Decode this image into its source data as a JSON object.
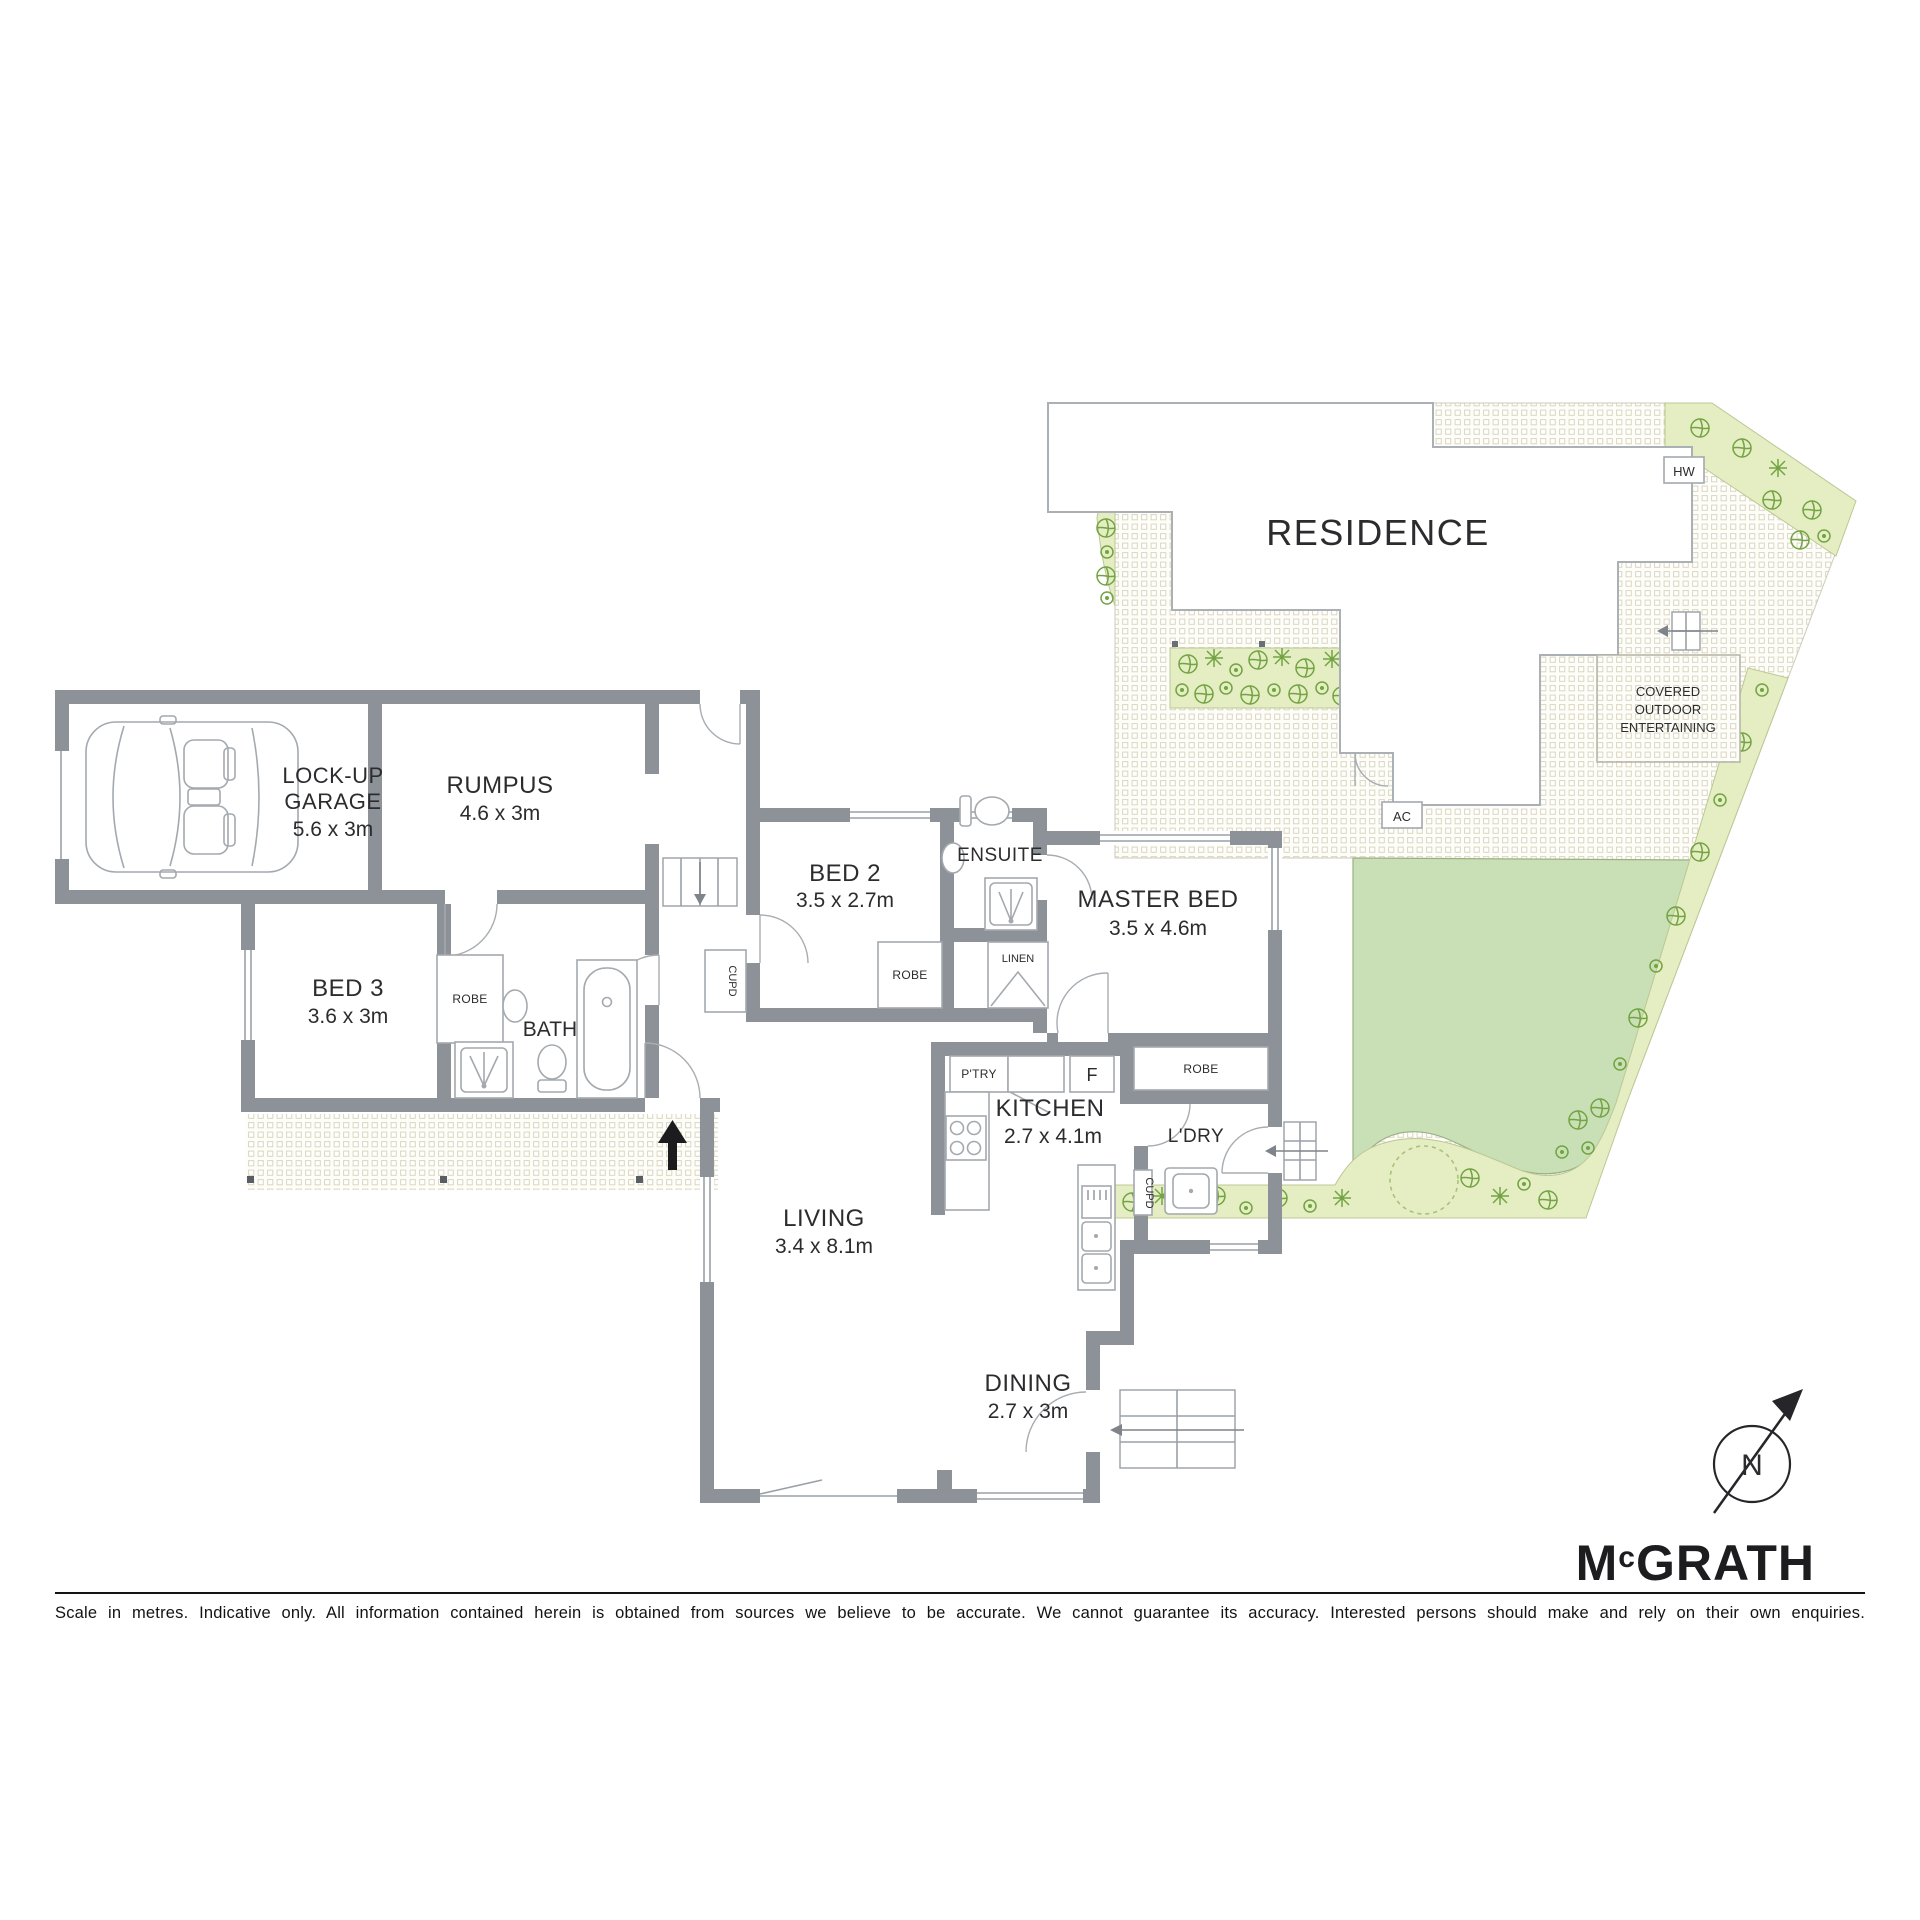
{
  "floor_plan": {
    "rooms": {
      "garage": {
        "name_line1": "LOCK-UP",
        "name_line2": "GARAGE",
        "dims": "5.6 x 3m"
      },
      "rumpus": {
        "name": "RUMPUS",
        "dims": "4.6 x 3m"
      },
      "bed2": {
        "name": "BED 2",
        "dims": "3.5 x 2.7m"
      },
      "ensuite": {
        "name": "ENSUITE"
      },
      "master_bed": {
        "name": "MASTER BED",
        "dims": "3.5 x 4.6m"
      },
      "bed3": {
        "name": "BED 3",
        "dims": "3.6 x 3m"
      },
      "bath": {
        "name": "BATH"
      },
      "kitchen": {
        "name": "KITCHEN",
        "dims": "2.7 x 4.1m"
      },
      "laundry": {
        "name": "L'DRY"
      },
      "living": {
        "name": "LIVING",
        "dims": "3.4 x 8.1m"
      },
      "dining": {
        "name": "DINING",
        "dims": "2.7 x 3m"
      }
    },
    "labels": {
      "robe": "ROBE",
      "linen": "LINEN",
      "cupd": "CUPD",
      "pantry": "P'TRY",
      "fridge": "F"
    }
  },
  "site_plan": {
    "residence": "RESIDENCE",
    "covered_outdoor_line1": "COVERED",
    "covered_outdoor_line2": "OUTDOOR",
    "covered_outdoor_line3": "ENTERTAINING",
    "hot_water": "HW",
    "air_con": "AC"
  },
  "compass": {
    "north": "N"
  },
  "branding": {
    "logo_m": "M",
    "logo_c": "c",
    "logo_rest": "GRATH"
  },
  "footer": {
    "disclaimer": "Scale in metres. Indicative only. All information contained herein is obtained from sources we believe to be accurate. We cannot guarantee its accuracy. Interested persons should make and rely on their own enquiries."
  },
  "colors": {
    "wall": "#8c9298",
    "lawn": "#c9e0b6",
    "garden": "#e4eec2",
    "plant": "#73a343"
  }
}
